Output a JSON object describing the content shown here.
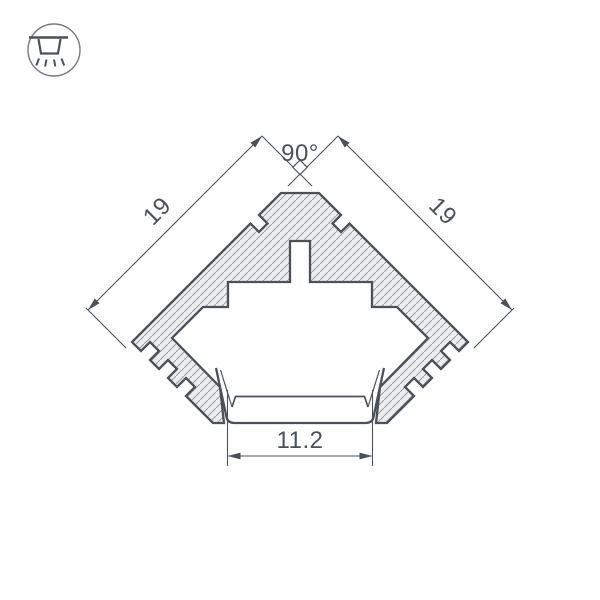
{
  "icon": {
    "name": "surface-mount-light-icon"
  },
  "drawing": {
    "dimensions": {
      "angle": "90°",
      "left_side": "19",
      "right_side": "19",
      "bottom_width": "11.2"
    },
    "colors": {
      "line": "#4b5157",
      "dim_line": "#5a6066",
      "hatch_line": "#99a0a6",
      "hatch_fill": "#ecedee",
      "icon_circle": "#75797d",
      "background": "#ffffff"
    }
  }
}
